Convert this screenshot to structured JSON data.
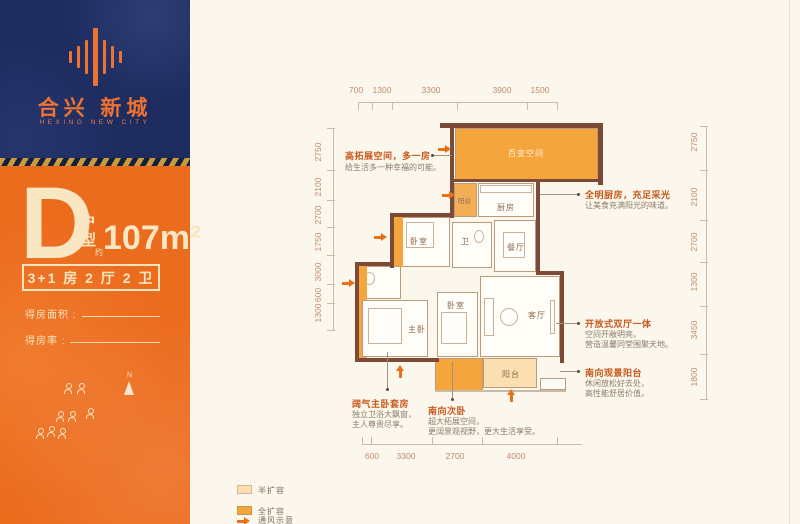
{
  "brand": {
    "name_cn": "合兴 新城",
    "name_en": "HEXING NEW CITY"
  },
  "unit": {
    "letter": "D",
    "type_label": "户型",
    "approx_label": "约",
    "area": "107m²",
    "layout": "3+1 房 2 厅 2 卫",
    "area_field_label": "得房面积 :",
    "rate_field_label": "得房率 :"
  },
  "compass": {
    "label": "N"
  },
  "plan": {
    "dims_top": [
      "700",
      "1300",
      "3300",
      "3900",
      "1500"
    ],
    "dims_left": [
      "2750",
      "2100",
      "2700",
      "1750",
      "3000",
      "600",
      "1300"
    ],
    "dims_right": [
      "2750",
      "2100",
      "2700",
      "1300",
      "3450",
      "1800"
    ],
    "dims_bottom": [
      "600",
      "3300",
      "2700",
      "4000"
    ],
    "rooms": {
      "flex_space": "百变空间",
      "balcony_top": "阳台",
      "kitchen": "厨房",
      "bedroom_top": "卧室",
      "bath": "卫",
      "dining": "餐厅",
      "master": "主卧",
      "bedroom2": "卧室",
      "living": "客厅",
      "balcony_bottom": "阳台"
    }
  },
  "annotations": [
    {
      "title": "高拓展空间，多一房",
      "lines": [
        "给生活多一种幸福的可能。"
      ]
    },
    {
      "title": "全明厨房，充足采光",
      "lines": [
        "让美食充满阳光的味道。"
      ]
    },
    {
      "title": "开放式双厅一体",
      "lines": [
        "空间开敞明亮，",
        "营造温馨同堂围聚天地。"
      ]
    },
    {
      "title": "南向观景阳台",
      "lines": [
        "休闲放松好去处，",
        "高性能舒居价值。"
      ]
    },
    {
      "title": "阔气主卧套房",
      "lines": [
        "独立卫浴大飘窗，",
        "主人尊贵尽享。"
      ]
    },
    {
      "title": "南向次卧",
      "lines": [
        "超大拓展空间，",
        "更阔景观视野，更大生活享受。"
      ]
    }
  ],
  "legend": {
    "half": "半扩容",
    "full": "全扩容",
    "vent": "通风示意"
  },
  "colors": {
    "brand_orange": "#ee7230",
    "panel_orange": "#ec6c1e",
    "navy": "#1d2b5e",
    "full_fill": "#f4a53c",
    "half_fill": "#fbdfb0",
    "wall": "#7c4a36",
    "cream": "#f7e6c3"
  }
}
